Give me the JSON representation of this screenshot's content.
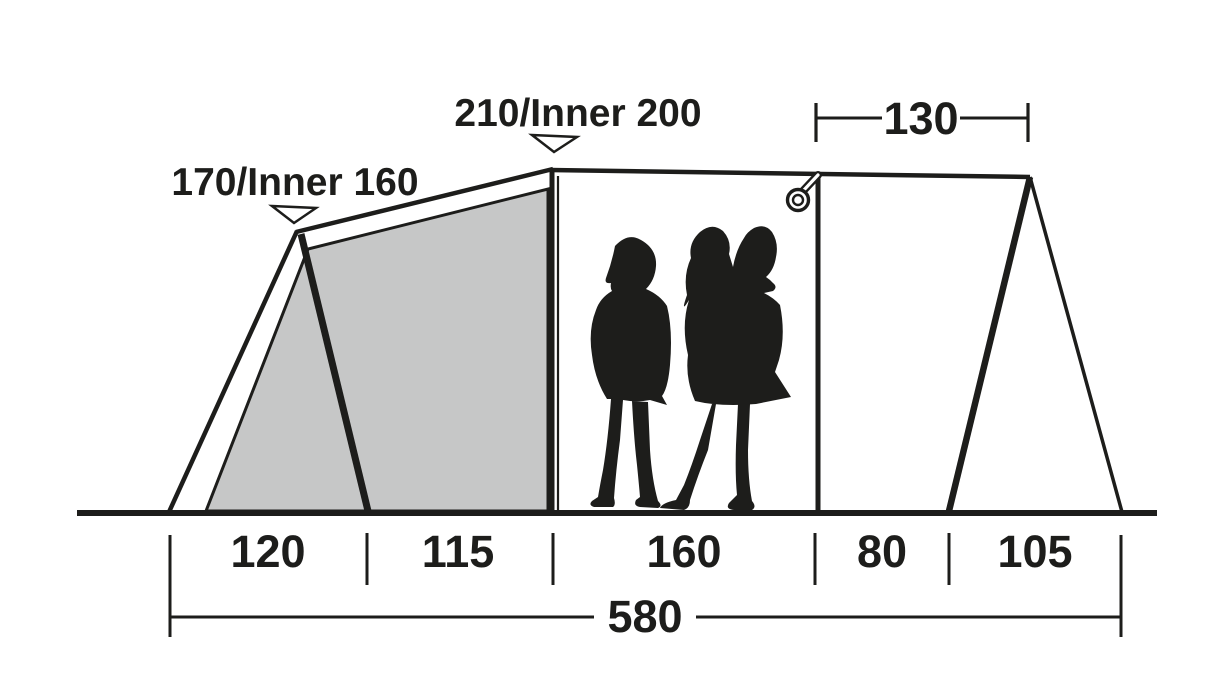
{
  "figure": {
    "type": "tent-side-profile-dimension-diagram",
    "height_labels": [
      {
        "id": "front-peak",
        "text": "170/Inner 160"
      },
      {
        "id": "main-peak",
        "text": "210/Inner 200"
      }
    ],
    "top_width_label": "130",
    "floor_segments": [
      "120",
      "115",
      "160",
      "80",
      "105"
    ],
    "total_length": "580",
    "icons": [
      "pointer-triangle-icon",
      "hanging-loop-icon",
      "people-scale-silhouette"
    ],
    "colors": {
      "line": "#1d1d1b",
      "inner_fill": "#c6c7c7",
      "background": "#ffffff"
    }
  }
}
